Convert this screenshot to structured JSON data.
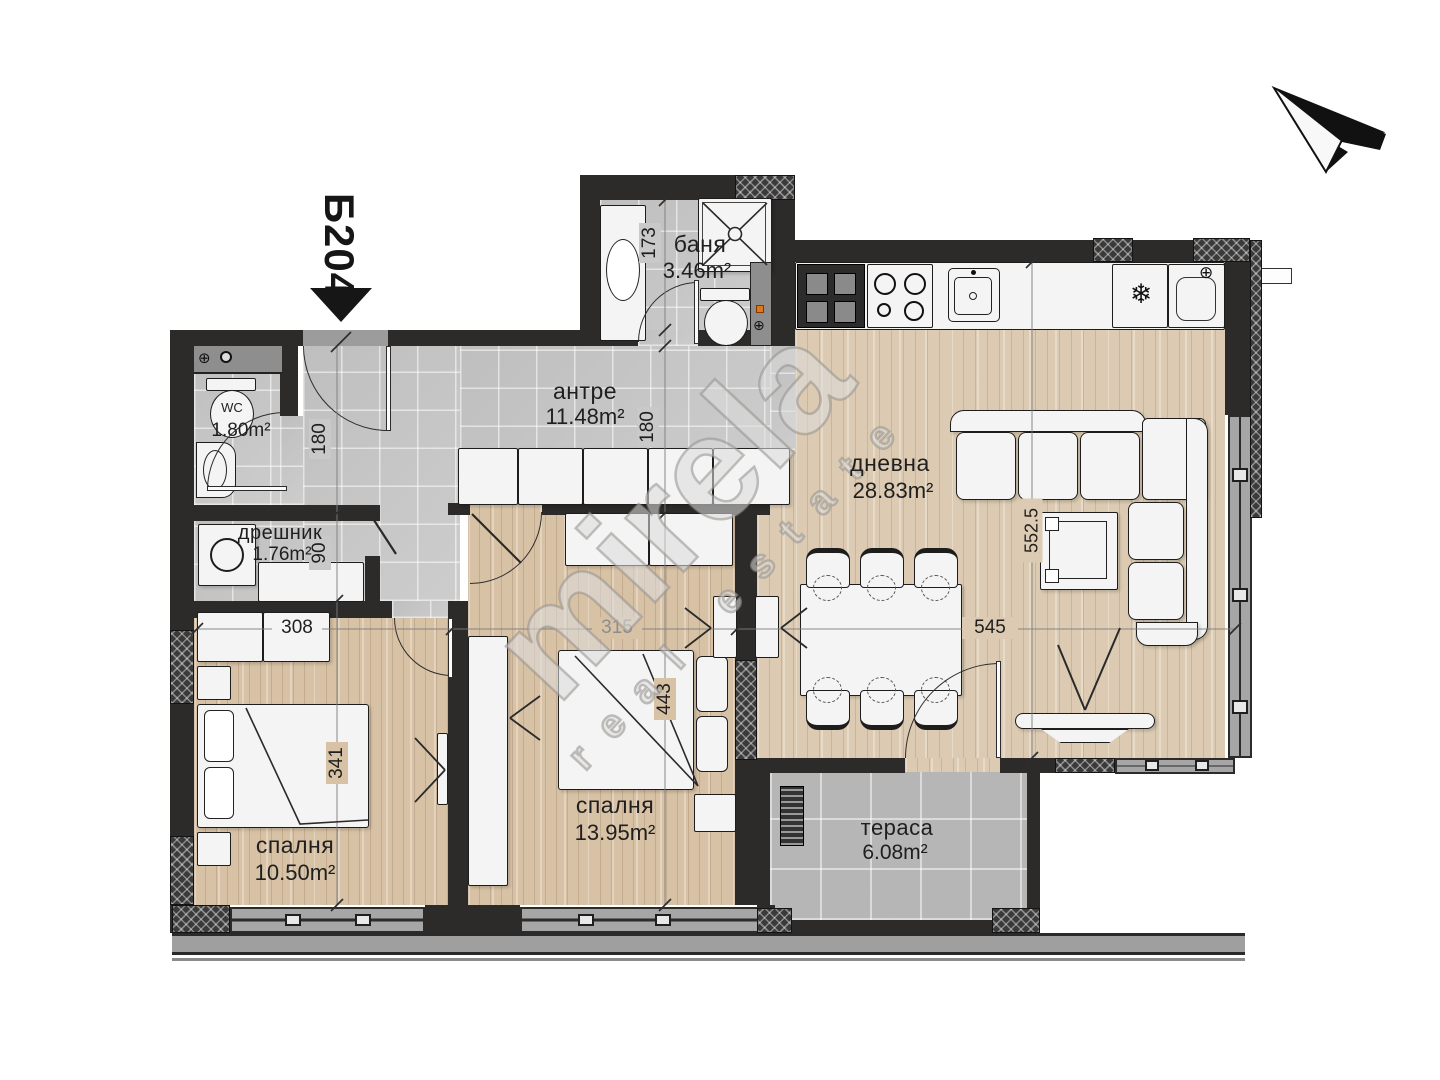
{
  "unit": {
    "label": "Б204"
  },
  "rooms": {
    "hallway": {
      "name": "антре",
      "area": "11.48m²"
    },
    "bathroom": {
      "name": "баня",
      "area": "3.46m²"
    },
    "wc": {
      "area": "1.80m²",
      "fixture_label": "WC"
    },
    "closet": {
      "name": "дрешник",
      "area": "1.76m²"
    },
    "living": {
      "name": "дневна",
      "area": "28.83m²"
    },
    "bedroom1": {
      "name": "спалня",
      "area": "10.50m²"
    },
    "bedroom2": {
      "name": "спалня",
      "area": "13.95m²"
    },
    "terrace": {
      "name": "тераса",
      "area": "6.08m²"
    }
  },
  "dimensions": {
    "bathroom_height": "173",
    "hallway_left_height": "180",
    "closet_height": "90",
    "hallway_right_height": "180",
    "bedroom1_width": "308",
    "bedroom1_height": "341",
    "bedroom2_width": "315",
    "bedroom2_height": "443",
    "living_width": "545",
    "living_height": "552.5"
  },
  "icons": {
    "fridge_snowflake": "❄",
    "corner_sink_faucet": "⊕",
    "wc_shaft_valve": "⊕",
    "bath_shaft_valve": "⊕"
  },
  "watermark": {
    "brand": "mirela",
    "tagline": "real estate"
  }
}
